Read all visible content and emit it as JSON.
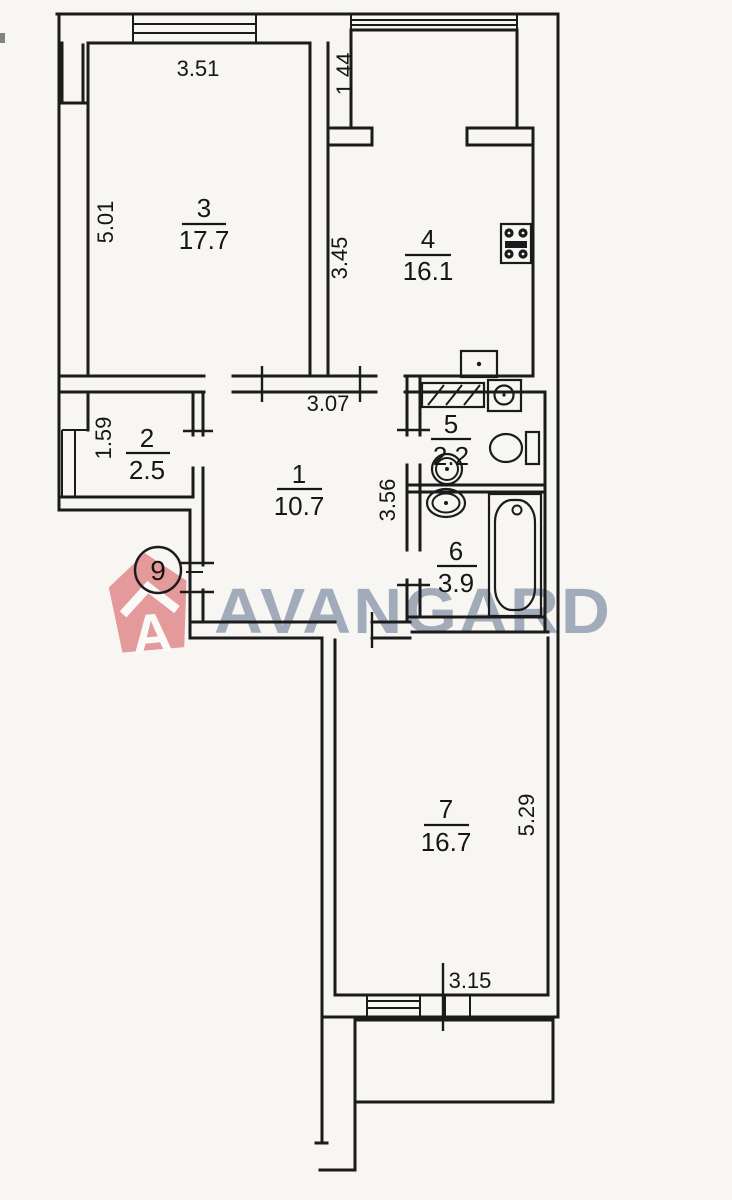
{
  "plan": {
    "type": "apartment-floor-plan",
    "rooms": [
      {
        "number": "1",
        "area": "10.7"
      },
      {
        "number": "2",
        "area": "2.5"
      },
      {
        "number": "3",
        "area": "17.7"
      },
      {
        "number": "4",
        "area": "16.1"
      },
      {
        "number": "5",
        "area": "2.2"
      },
      {
        "number": "6",
        "area": "3.9"
      },
      {
        "number": "7",
        "area": "16.7"
      }
    ],
    "dimensions": [
      {
        "value": "3.51",
        "room": "3",
        "edge": "top"
      },
      {
        "value": "5.01",
        "room": "3",
        "edge": "left"
      },
      {
        "value": "1.44",
        "room": "balcony",
        "edge": "left"
      },
      {
        "value": "3.45",
        "room": "4",
        "edge": "left"
      },
      {
        "value": "3.07",
        "room": "1",
        "edge": "top"
      },
      {
        "value": "1.59",
        "room": "2",
        "edge": "left"
      },
      {
        "value": "3.56",
        "room": "1",
        "edge": "right"
      },
      {
        "value": "5.29",
        "room": "7",
        "edge": "right"
      },
      {
        "value": "3.15",
        "room": "7",
        "edge": "bottom"
      }
    ],
    "floor_marker": "9",
    "fixtures": [
      "stove-icon",
      "kitchen-sink-icon",
      "cabinet-icon",
      "washing-machine-icon",
      "toilet-icon",
      "washbasin-icon",
      "washbasin-icon",
      "bathtub-icon",
      "window-icon",
      "door-opening"
    ]
  },
  "watermark": {
    "brand": "AVANGARD",
    "logo_letter": "A"
  },
  "colors": {
    "line": "#1b1b1b",
    "paper": "#f7f6f2",
    "logo_red": "#d65055",
    "watermark_text": "#8c99ad"
  }
}
